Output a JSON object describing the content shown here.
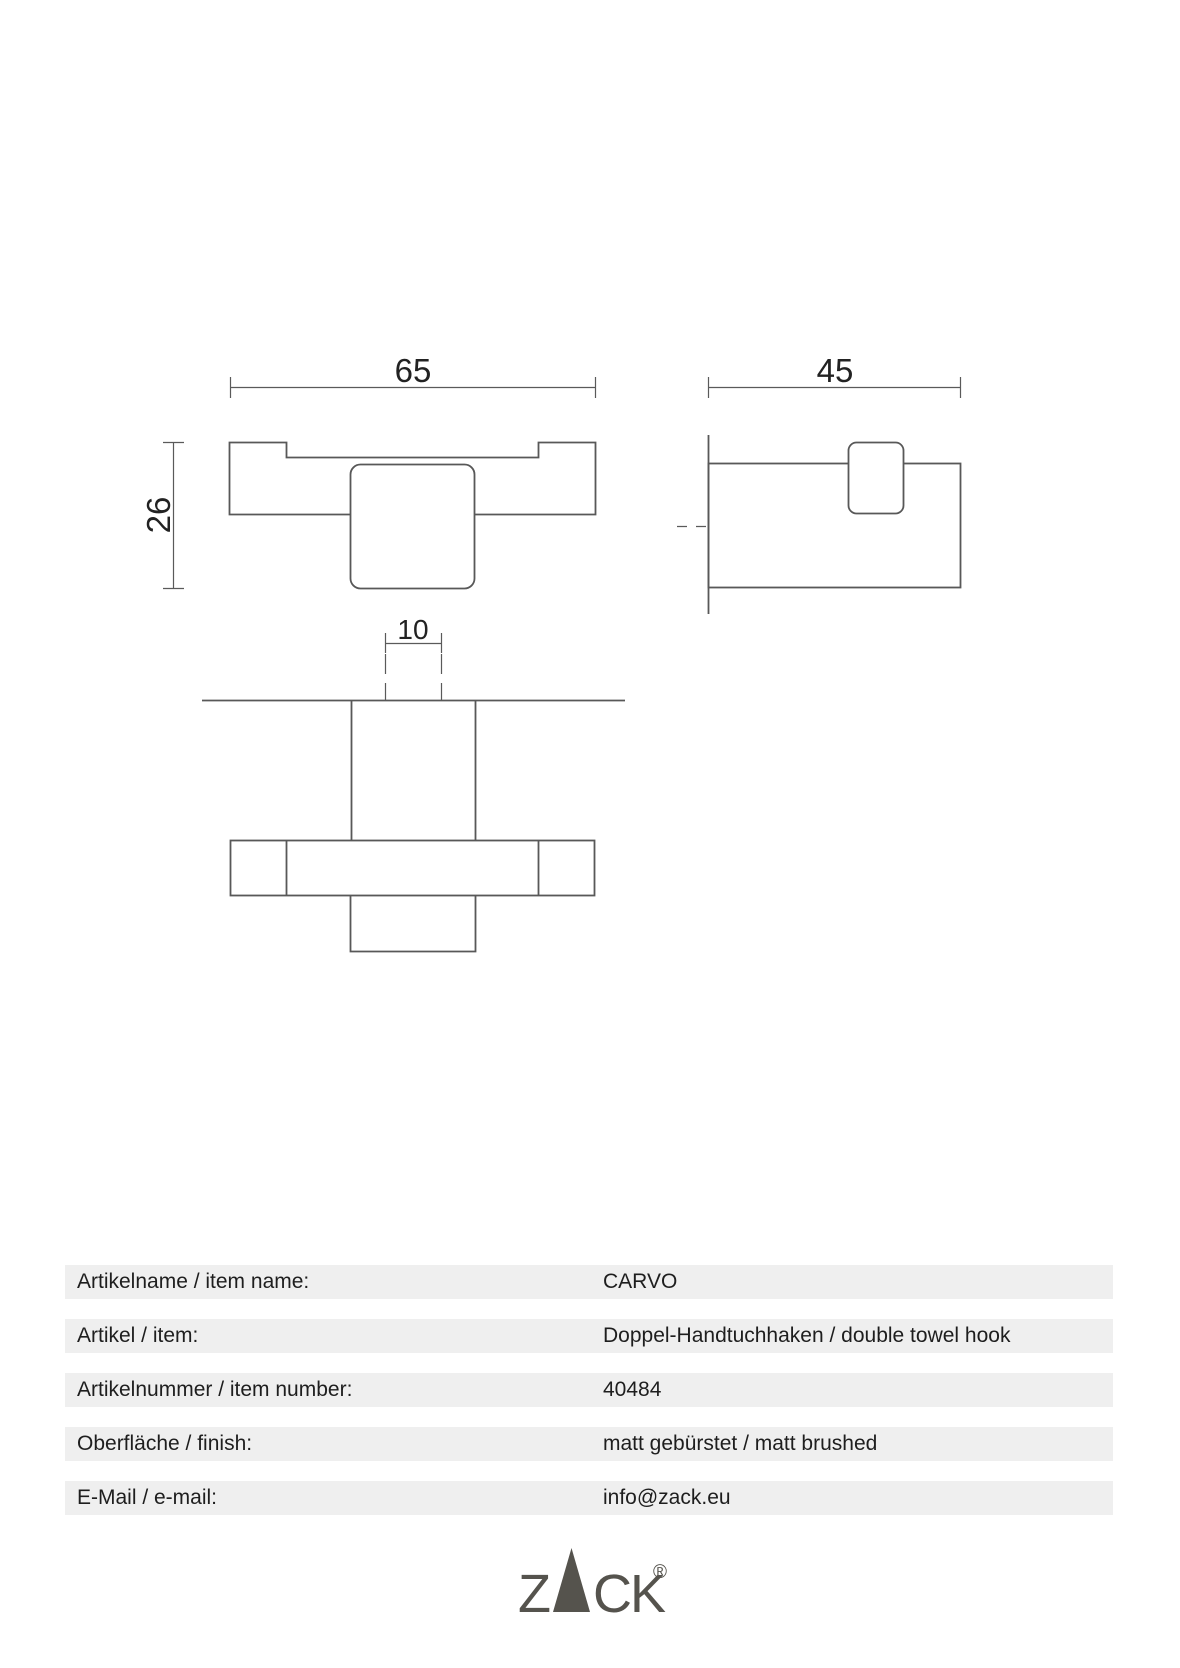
{
  "colors": {
    "page_background": "#ffffff",
    "drawing_line": "#585858",
    "dimension_line": "#5a5a5a",
    "table_band": "#efefef",
    "table_text": "#1e1e1e",
    "logo": "#55534d"
  },
  "drawing": {
    "front_view": {
      "width_dim": "65",
      "height_dim": "26"
    },
    "side_view": {
      "depth_dim": "45"
    },
    "bottom_view": {
      "hook_width_dim": "10"
    }
  },
  "table": {
    "rows": [
      {
        "label": "Artikelname / item name:",
        "value": "CARVO"
      },
      {
        "label": "Artikel / item:",
        "value": "Doppel-Handtuchhaken / double towel hook"
      },
      {
        "label": "Artikelnummer / item number:",
        "value": "40484"
      },
      {
        "label": "Oberfläche / finish:",
        "value": "matt gebürstet / matt brushed"
      },
      {
        "label": "E-Mail / e-mail:",
        "value": "info@zack.eu"
      }
    ]
  },
  "logo": {
    "z": "Z",
    "ck": "CK",
    "triangle_letter": "A",
    "registered": "®"
  }
}
